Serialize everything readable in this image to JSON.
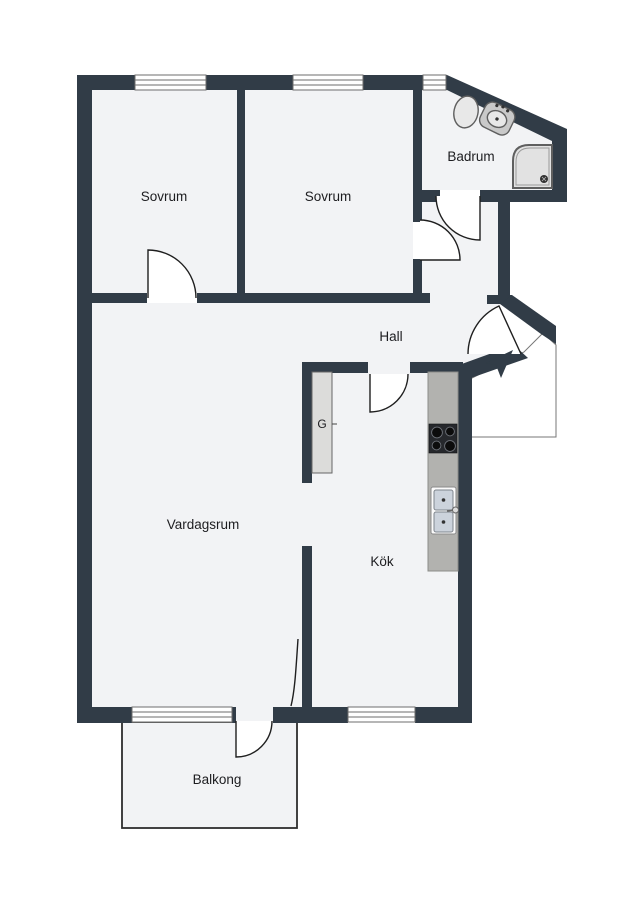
{
  "floorplan": {
    "colors": {
      "wall": "#313c47",
      "floor": "#f2f3f5",
      "windowframe": "#6e6e6e",
      "door": "#1f1f1f",
      "labelcolor": "#1d1d20",
      "counter": "#b2b2af",
      "counteredge": "#8c8c89",
      "closet": "#dcdcda",
      "fixturefill": "#e8e8e8",
      "fixturestroke": "#5f5f5f",
      "stove": "#26282c",
      "burner": "#0c0c0c",
      "basin": "#ccd3dc",
      "landingedge": "#777777",
      "balconyedge": "#2e2e2e"
    },
    "rooms": [
      {
        "id": "sovrum-1",
        "label": "Sovrum"
      },
      {
        "id": "sovrum-2",
        "label": "Sovrum"
      },
      {
        "id": "badrum",
        "label": "Badrum"
      },
      {
        "id": "hall",
        "label": "Hall"
      },
      {
        "id": "vardagsrum",
        "label": "Vardagsrum"
      },
      {
        "id": "kok",
        "label": "Kök"
      },
      {
        "id": "balkong",
        "label": "Balkong"
      },
      {
        "id": "garderob",
        "label": "G"
      }
    ],
    "fixtures": [
      "toilet",
      "bathroom-sink",
      "shower",
      "kitchen-counter",
      "stove",
      "kitchen-sink",
      "wardrobe",
      "entrance-arrow"
    ]
  }
}
